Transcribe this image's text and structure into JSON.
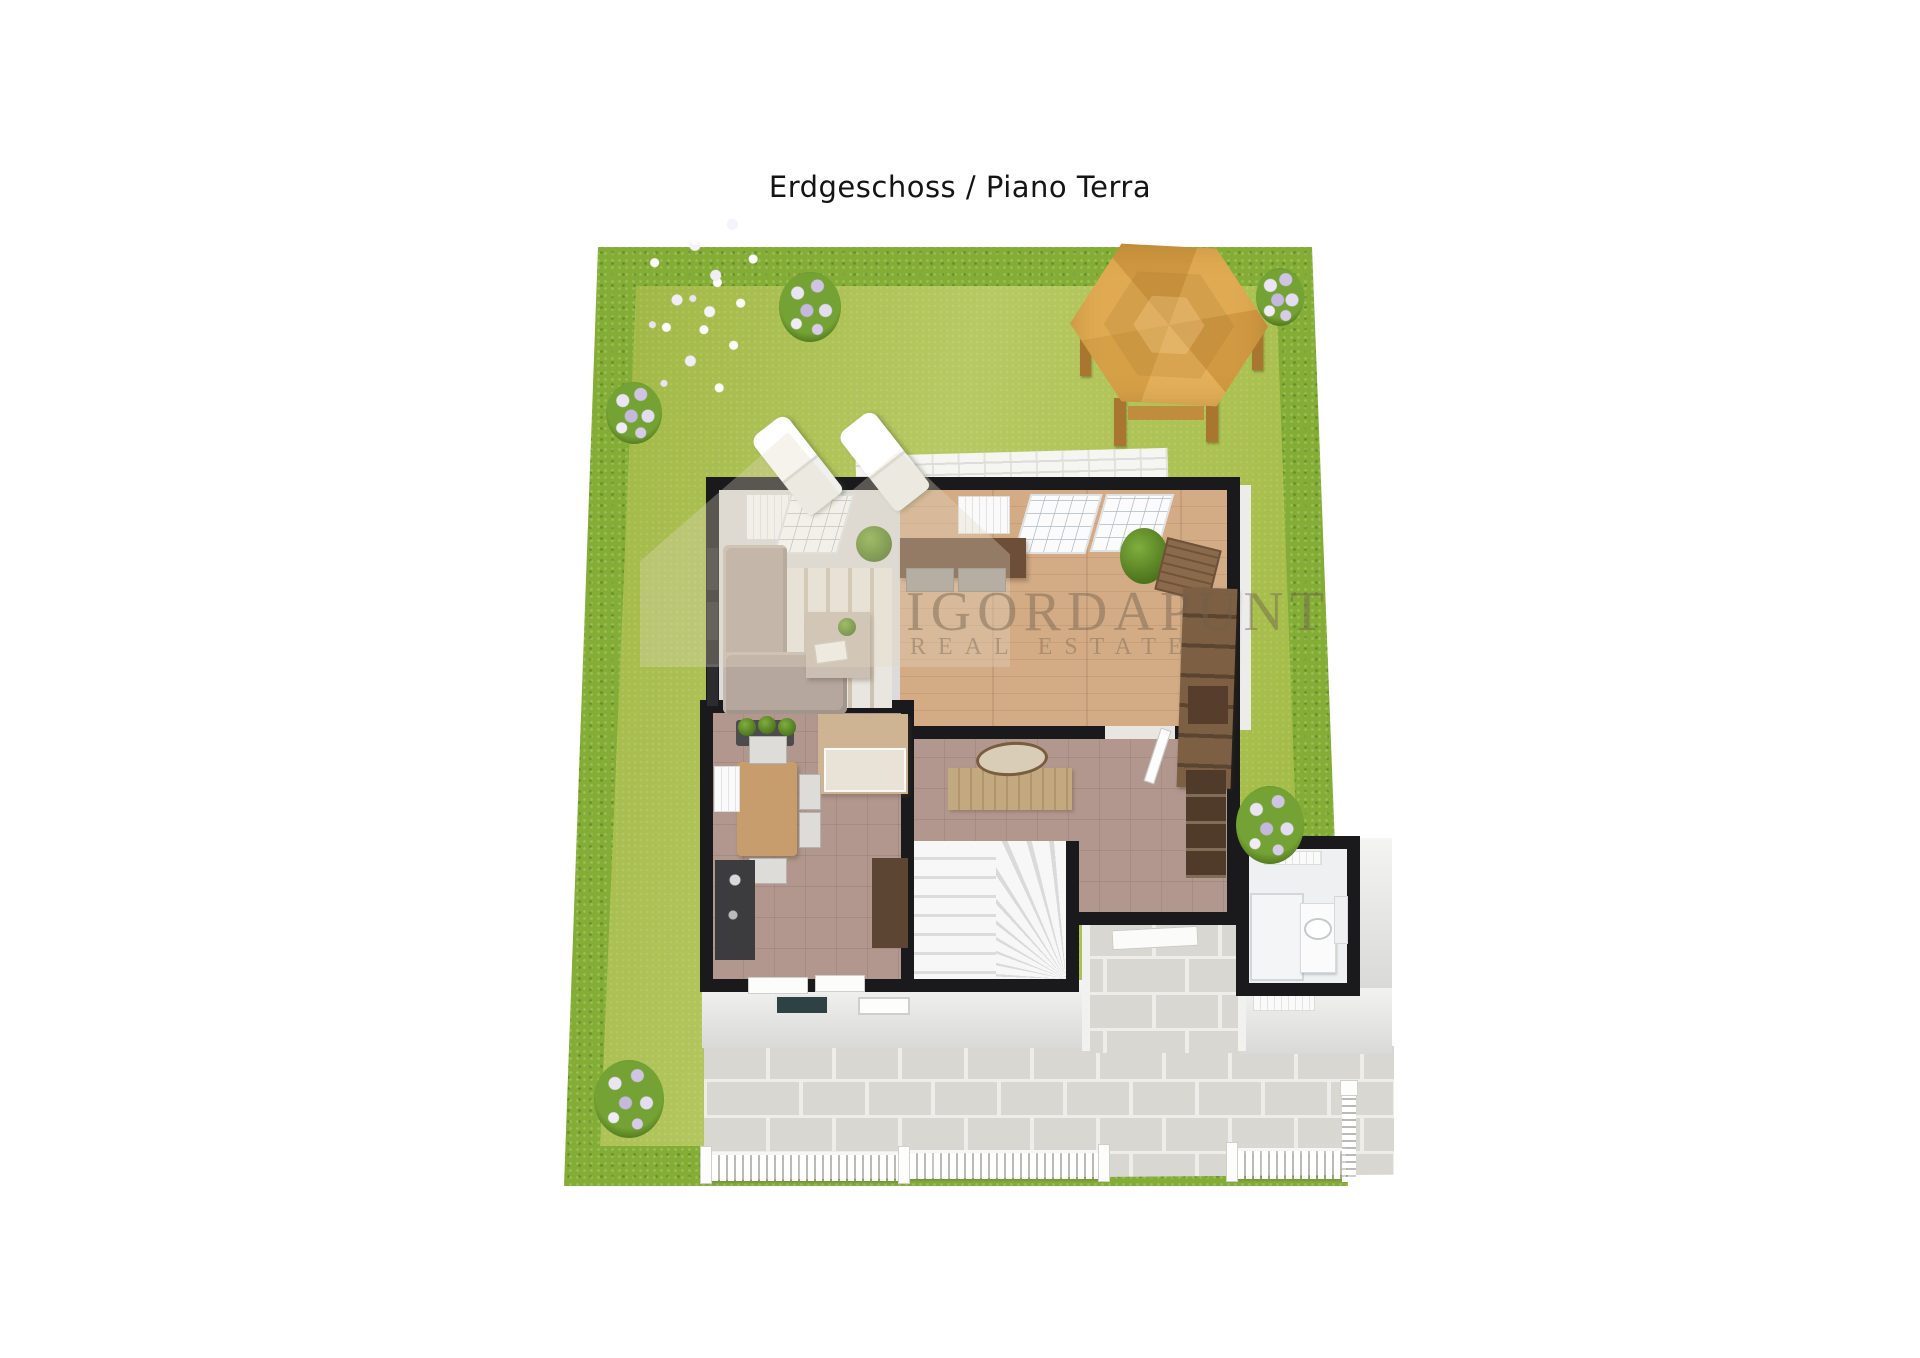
{
  "title": "Erdgeschoss / Piano Terra",
  "watermark": {
    "brand": "IGORDAPUNT",
    "tagline": "REAL ESTATE"
  },
  "scene": {
    "type": "3d-floor-plan-render",
    "floor": "ground floor",
    "colors": {
      "grass": "#a8bf4d",
      "hedge": "#84ad36",
      "paver": "#d8d7d2",
      "paver_grout": "#eeede9",
      "gazebo_wood": "#dda94f",
      "wood_floor": "#cda57f",
      "tile_mauve": "#b2978e",
      "living_floor": "#dcdbd9",
      "bath_tile": "#eef0f1",
      "wall_outline": "#1a1a1c",
      "facade": "#ededeb",
      "fence": "#ffffff",
      "flower": "#d6cce8",
      "sofa": "#b5a79d"
    },
    "objects": [
      "garden-hedge",
      "garden-grass",
      "hexagonal-gazebo",
      "sun-loungers",
      "terrace-tiles",
      "living-room",
      "dining-area",
      "kitchen",
      "hallway",
      "staircase",
      "bathroom",
      "entrance-porch",
      "corner-sofa",
      "area-rug",
      "coffee-table",
      "sideboard-with-benches",
      "potted-plant",
      "wicker-chest",
      "rustic-console",
      "kitchen-table",
      "buffet-cabinet",
      "kitchen-counter",
      "console-table",
      "oval-mirror",
      "coat-rack",
      "shower",
      "vanity-sink",
      "stone-patio",
      "picket-fence",
      "flower-bushes"
    ]
  }
}
